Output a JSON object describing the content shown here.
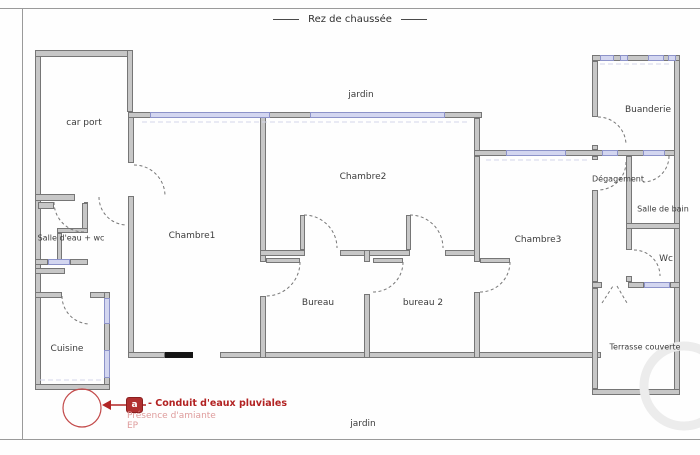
{
  "title": "Rez de chaussée",
  "environment": {
    "garden_top": "jardin",
    "garden_bottom": "jardin"
  },
  "rooms": [
    {
      "id": "car-port",
      "label": "car port"
    },
    {
      "id": "salle-eau-wc",
      "label": "Salle d'eau + wc"
    },
    {
      "id": "cuisine",
      "label": "Cuisine"
    },
    {
      "id": "chambre1",
      "label": "Chambre1"
    },
    {
      "id": "chambre2",
      "label": "Chambre2"
    },
    {
      "id": "bureau",
      "label": "Bureau"
    },
    {
      "id": "bureau2",
      "label": "bureau 2"
    },
    {
      "id": "chambre3",
      "label": "Chambre3"
    },
    {
      "id": "buanderie",
      "label": "Buanderie"
    },
    {
      "id": "degagement",
      "label": "Dégagement"
    },
    {
      "id": "salle-de-bain",
      "label": "Salle de bain"
    },
    {
      "id": "wc",
      "label": "Wc"
    },
    {
      "id": "terrasse",
      "label": "Terrasse couverte"
    }
  ],
  "annotation": {
    "icon_letter": "a",
    "label_bold": "- Conduit d'eaux pluviales",
    "label_line2": "Présence d'amiante",
    "label_line3": "EP"
  },
  "colors": {
    "wall_fill": "#c7c7c7",
    "wall_edge": "#767676",
    "window": "#d3d6f0",
    "annotation_red": "#b22222",
    "annotation_light": "#de9c9c"
  }
}
